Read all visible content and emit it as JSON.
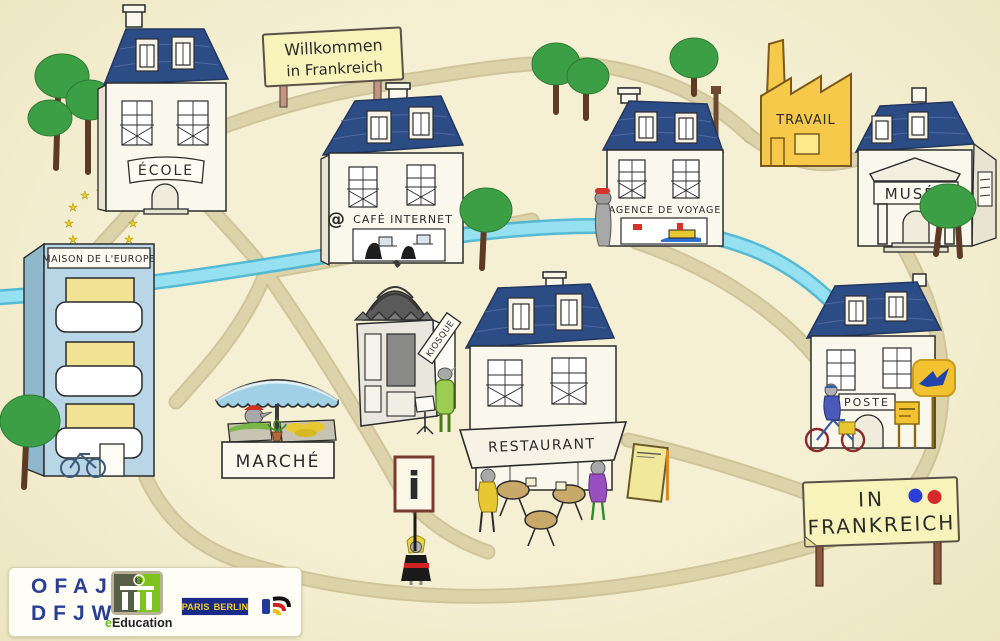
{
  "signs": {
    "welcome": {
      "line1": "Willkommen",
      "line2": "in Frankreich"
    },
    "frankreich": {
      "line1": "IN",
      "line2": "FRANKREICH"
    },
    "info": "i"
  },
  "locations": {
    "ecole": "ÉCOLE",
    "cafe_internet": "CAFÉ INTERNET",
    "agence_de_voyage": "AGENCE DE VOYAGE",
    "travail": "TRAVAIL",
    "musee": "MUSÉE",
    "maison_de_leurope": "MAISON DE L'EUROPE",
    "kiosque": "KIOSQUE",
    "marche": "MARCHÉ",
    "restaurant": "RESTAURANT",
    "poste": "POSTE"
  },
  "footer": {
    "ofaj": {
      "line1": "OFAJ",
      "line2": "DFJW"
    },
    "eeducation": {
      "e": "e",
      "rest": "Education"
    },
    "paris_berlin": {
      "left": "PARIS",
      "right": "BERLIN"
    }
  },
  "colors": {
    "background": "#f3eecd",
    "road": "#ddd3ab",
    "river": "#95e0f1",
    "roof_blue": "#2c4c86",
    "factory_yellow": "#f6c94a",
    "europe_blue": "#b8d6e6",
    "sign_yellow": "#f8f3bb",
    "tree_green": "#3d9f45",
    "laposte_yellow": "#f2c231",
    "logo_blue": "#2a3f94",
    "french_blue": "#2a3fd4",
    "french_red": "#d42a2a"
  }
}
